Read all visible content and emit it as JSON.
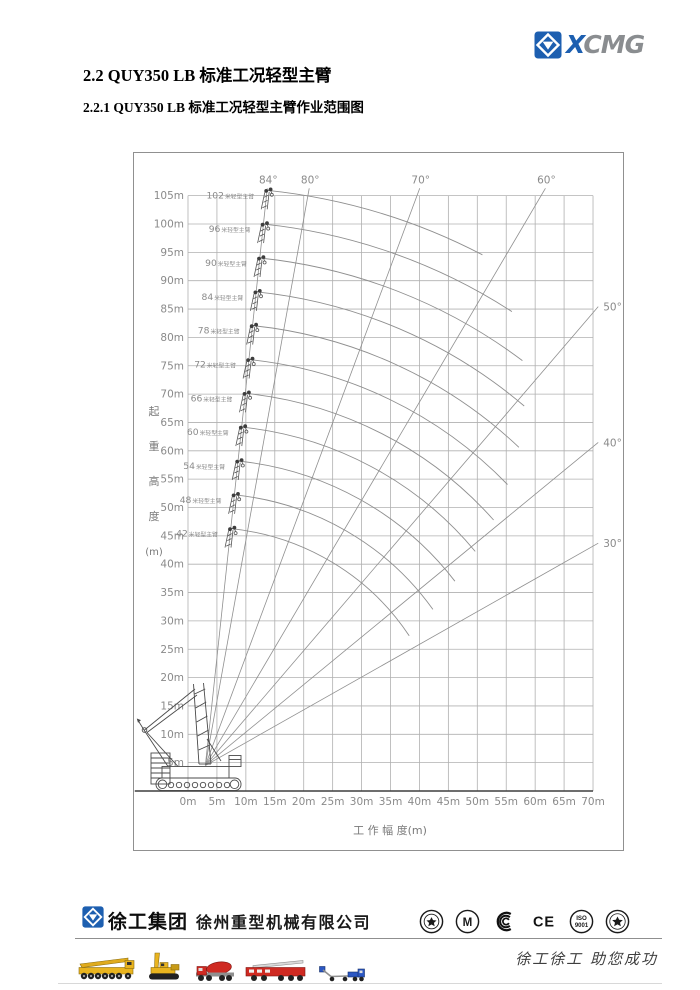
{
  "page": {
    "heading": "2.2 QUY350 LB 标准工况轻型主臂",
    "subheading": "2.2.1 QUY350 LB 标准工况轻型主臂作业范围图"
  },
  "brand": {
    "word_first": "X",
    "word_rest": "CMG",
    "logo_blue": "#1d5fb0",
    "logo_gray": "#8a8d90"
  },
  "chart_data": {
    "type": "line",
    "title": "QUY350 LB 标准工况轻型主臂作业范围图",
    "xlabel": "工  作  幅  度(m)",
    "ylabel": "起重高度(m)",
    "ylabel_chars": [
      "起",
      "重",
      "高",
      "度",
      "(m)"
    ],
    "xlim": [
      0,
      70
    ],
    "ylim": [
      0,
      105
    ],
    "grid": true,
    "x_tick_labels": [
      "0m",
      "5m",
      "10m",
      "15m",
      "20m",
      "25m",
      "30m",
      "35m",
      "40m",
      "45m",
      "50m",
      "55m",
      "60m",
      "65m",
      "70m"
    ],
    "y_tick_labels": [
      "5m",
      "10m",
      "15m",
      "20m",
      "25m",
      "30m",
      "35m",
      "40m",
      "45m",
      "50m",
      "55m",
      "60m",
      "65m",
      "70m",
      "75m",
      "80m",
      "85m",
      "90m",
      "95m",
      "100m",
      "105m"
    ],
    "boom_pivot_m": {
      "x": 3,
      "y": 4.5
    },
    "angle_lines": [
      {
        "deg": 84,
        "label": "84°"
      },
      {
        "deg": 80,
        "label": "80°"
      },
      {
        "deg": 70,
        "label": "70°"
      },
      {
        "deg": 60,
        "label": "60°"
      },
      {
        "deg": 50,
        "label": "50°"
      },
      {
        "deg": 40,
        "label": "40°"
      },
      {
        "deg": 30,
        "label": "30°"
      }
    ],
    "boom_series": [
      {
        "length_m": 102,
        "label": "102米轻型主臂",
        "max_angle_deg": 84,
        "min_angle_deg": 62
      },
      {
        "length_m": 96,
        "label": "96米轻型主臂",
        "max_angle_deg": 84,
        "min_angle_deg": 56.5
      },
      {
        "length_m": 90,
        "label": "90米轻型主臂",
        "max_angle_deg": 84,
        "min_angle_deg": 52.5
      },
      {
        "length_m": 84,
        "label": "84米轻型主臂",
        "max_angle_deg": 84,
        "min_angle_deg": 49
      },
      {
        "length_m": 78,
        "label": "78米轻型主臂",
        "max_angle_deg": 84,
        "min_angle_deg": 46
      },
      {
        "length_m": 72,
        "label": "72米轻型主臂",
        "max_angle_deg": 84,
        "min_angle_deg": 43.5
      },
      {
        "length_m": 66,
        "label": "66米轻型主臂",
        "max_angle_deg": 84,
        "min_angle_deg": 41
      },
      {
        "length_m": 60,
        "label": "60米轻型主臂",
        "max_angle_deg": 84,
        "min_angle_deg": 39
      },
      {
        "length_m": 54,
        "label": "54米轻型主臂",
        "max_angle_deg": 84,
        "min_angle_deg": 37
      },
      {
        "length_m": 48,
        "label": "48米轻型主臂",
        "max_angle_deg": 84,
        "min_angle_deg": 35
      },
      {
        "length_m": 42,
        "label": "42米轻型主臂",
        "max_angle_deg": 84,
        "min_angle_deg": 33
      }
    ],
    "grid_color": "#b0b0b0",
    "line_color": "#8f8f8f",
    "axis_color": "#3f3f3f",
    "label_color": "#8a8a8a"
  },
  "footer": {
    "company_logo_text": "徐工集团",
    "company_name": "徐州重型机械有限公司",
    "slogan": "徐工徐工 助您成功",
    "cert_marks": [
      "quality-award-seal",
      "metrology-m-seal",
      "ccc-mark",
      "ce-mark",
      "iso9001-seal",
      "inspection-star-seal"
    ],
    "vehicles": [
      "all-terrain-crane",
      "crawler-crane",
      "concrete-mixer-truck",
      "fire-ladder-truck",
      "aerial-work-platform"
    ]
  }
}
